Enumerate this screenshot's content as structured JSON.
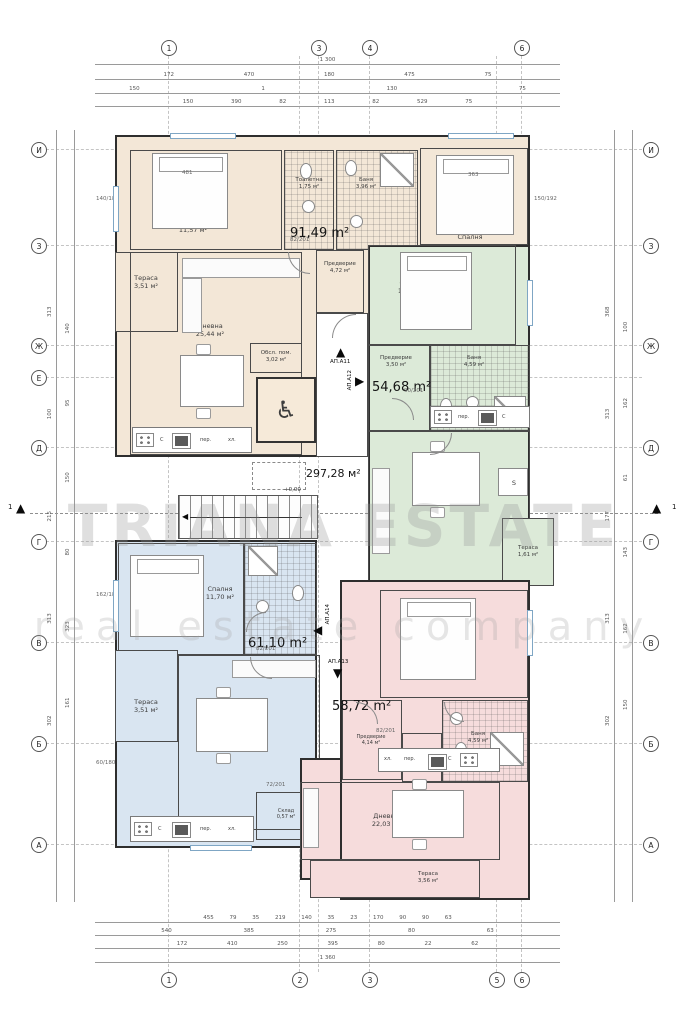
{
  "watermark": {
    "l1": "TRIANA ESTATE",
    "l2": "real estate company"
  },
  "common": {
    "area": "297,28 м²",
    "level": "+0,00",
    "wheelchair": "♿",
    "wardrobe": "S"
  },
  "apartments": {
    "a11": {
      "id": "АП.А11",
      "area": "91,49 m²",
      "rooms": {
        "bed1": {
          "n": "Спалня",
          "a": "11,57 м²"
        },
        "bed2": {
          "n": "Спалня",
          "a": ""
        },
        "wc": {
          "n": "Тоалетна",
          "a": "1,75 м²"
        },
        "bath": {
          "n": "Баня",
          "a": "3,96 м²"
        },
        "hall": {
          "n": "Предверие",
          "a": "4,72 м²"
        },
        "serv": {
          "n": "Обсл. пом.",
          "a": "3,02 м²"
        },
        "living": {
          "n": "Дневна",
          "a": "25,44 м²"
        },
        "terrace": {
          "n": "Тераса",
          "a": "3,51 м²"
        }
      }
    },
    "a12": {
      "id": "АП.А12",
      "area": "54,68 m²",
      "rooms": {
        "bed": {
          "n": "Спалня",
          "a": "13,43 м²"
        },
        "hall": {
          "n": "Предверие",
          "a": "3,50 м²"
        },
        "bath": {
          "n": "Баня",
          "a": "4,59 м²"
        },
        "living": {
          "n": "Дневна",
          "a": "24,30 м²"
        },
        "terrace": {
          "n": "Тераса",
          "a": "1,61 м²"
        }
      }
    },
    "a13": {
      "id": "АП.А13",
      "area": "58,72 m²",
      "rooms": {
        "bed": {
          "n": "Спалня",
          "a": "13,05 м²"
        },
        "hall": {
          "n": "Предверие",
          "a": "4,14 м²"
        },
        "storage": {
          "n": "Склад",
          "a": "1,21 м²"
        },
        "bath": {
          "n": "Баня",
          "a": "4,59 м²"
        },
        "living": {
          "n": "Дневна",
          "a": "22,03 м²"
        },
        "terrace": {
          "n": "Тераса",
          "a": "3,56 м²"
        }
      }
    },
    "a14": {
      "id": "АП.А14",
      "area": "61,10 m²",
      "rooms": {
        "bed": {
          "n": "Спалня",
          "a": "11,70 м²"
        },
        "living": {
          "n": "Дневна",
          "a": "25,55 м²"
        },
        "storage": {
          "n": "Склад",
          "a": "0,57 м²"
        },
        "terrace": {
          "n": "Тераса",
          "a": "3,51 м²"
        }
      }
    }
  },
  "kitchen": {
    "stove": "С",
    "washer": "пер.",
    "fridge": "хл."
  },
  "doors": {
    "d82": "82/201",
    "d72": "72/201",
    "d90": "90/201"
  },
  "wins": {
    "w1": "140/180",
    "w2": "60/180",
    "w3": "162/180",
    "w4": "150/192"
  },
  "beds": {
    "b1": "481",
    "b2": "363"
  },
  "grid": {
    "top": [
      "1",
      "3",
      "4",
      "6"
    ],
    "bottom": [
      "1",
      "2",
      "3",
      "5",
      "6"
    ],
    "left": [
      "И",
      "З",
      "Ж",
      "Е",
      "Д",
      "Г",
      "В",
      "Б",
      "А"
    ],
    "right": [
      "И",
      "З",
      "Ж",
      "Е",
      "Д",
      "Г",
      "В",
      "Б",
      "А"
    ],
    "section": "1"
  },
  "dims": {
    "top1": "1 300",
    "top2": "172 470 180 475 75",
    "top3": "150 1 130 75",
    "top4": "150 390 82 113 82 529 75",
    "bot1": "455 79 35 219 140 35 23 170 90 90 63",
    "bot2": "540 385 275 80 63",
    "bot3": "172 410 250 395 80 22 62",
    "bot4": "1 360",
    "left1": "302 313 215 100 313",
    "left2": "161 323 80 150 95 140",
    "right1": "302 313 177 313 368",
    "right2": "150 162 143 61 162 100"
  }
}
